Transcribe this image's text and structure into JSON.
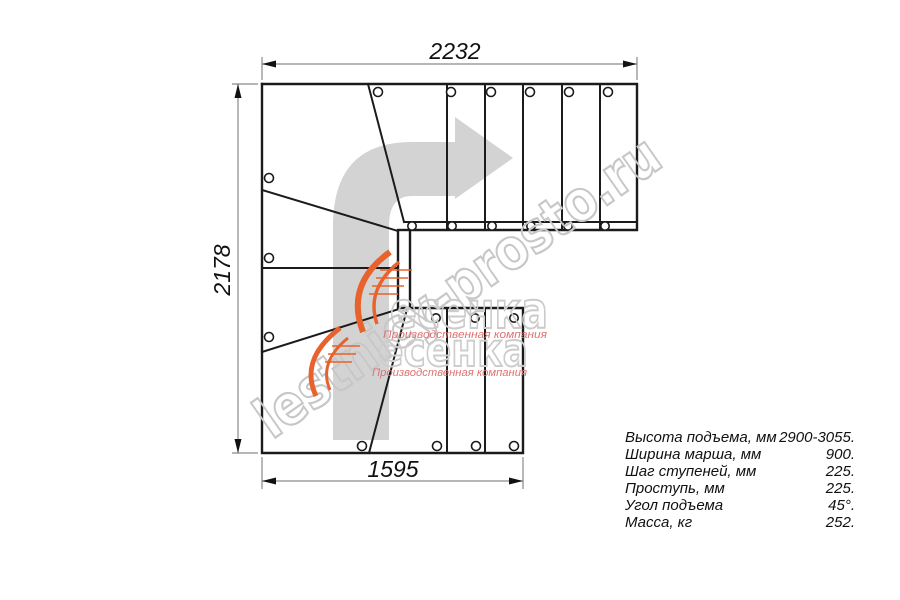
{
  "drawing": {
    "dimensions": {
      "top": "2232",
      "left": "2178",
      "bottom": "1595"
    },
    "watermark": {
      "diagonal_text": "lestnicy-prosto.ru",
      "logo_text": "есенка",
      "logo_caption": "Производственная компания"
    },
    "icons": {
      "direction_arrow": "quarter-turn-up-right-arrow"
    },
    "colors": {
      "line": "#1b1b1b",
      "dimension_line": "#8a8a8a",
      "arrow_fill": "#d3d3d3",
      "watermark_gray": "#c7c7c7",
      "logo_orange": "#e8622d",
      "logo_red": "#dd7272"
    }
  },
  "specs": {
    "rows": [
      {
        "label": "Высота подъема, мм",
        "value": "2900-3055."
      },
      {
        "label": "Ширина марша, мм",
        "value": "900."
      },
      {
        "label": "Шаг ступеней, мм",
        "value": "225."
      },
      {
        "label": "Проступь, мм",
        "value": "225."
      },
      {
        "label": "Угол подъема",
        "value": "45°."
      },
      {
        "label": "Масса, кг",
        "value": "252."
      }
    ]
  }
}
